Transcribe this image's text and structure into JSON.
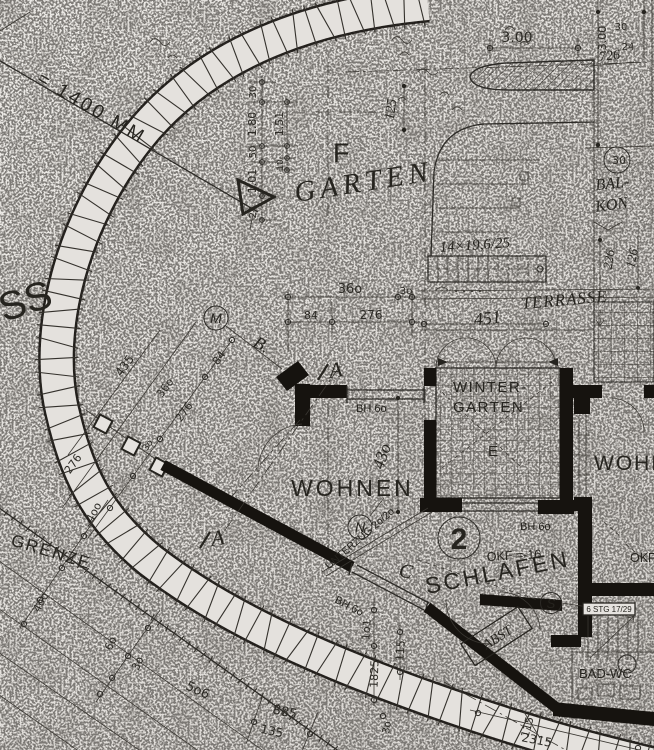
{
  "colors": {
    "paper": "#e6e3df",
    "ink": "#2a2824",
    "wall": "#16130f"
  },
  "rooms": {
    "garten": "GARTEN",
    "wohnen": "WOHNEN",
    "wohnen_right": "WOHN",
    "wintergarten_1": "WINTER-",
    "wintergarten_2": "GARTEN",
    "wintergarten_e": "E",
    "schlafen": "SCHLAFEN",
    "balkon_1": "BAL-",
    "balkon_2": "KON",
    "terrasse": "TERRASSE",
    "bad_wc": "BAD-WC",
    "abst": "ABST"
  },
  "ann": {
    "scale_note": "= 1400 MM",
    "edge_partial": "SS",
    "grenze": "GRENZE",
    "unterzug": "UNTERZUG 2o/2o",
    "stair_top": "14×19,6/25",
    "stair_right": "6 STG 17/29",
    "okf_schlafen": "OKF =-16",
    "okf_right": "OKF",
    "bh60_window": "BH 6o",
    "bh60_winter": "BH 6o",
    "bh60_wall": "BH 6o",
    "axis_f": "F"
  },
  "mk": {
    "m": "M",
    "n": "N",
    "s": "S",
    "unit": "2",
    "minus30": "-30",
    "sec_a": "A",
    "sec_a2": "A",
    "sec_b": "B.",
    "sec_c": "C"
  },
  "dims": {
    "top_300": "3.00",
    "tr_300": "3.00",
    "tr_30": "30",
    "tr_24": "24",
    "tr_726": "726",
    "lc_30": "30",
    "lc_180": "1.80",
    "lc_151": "1.51",
    "lc_50": "50",
    "lc_101": "1.01",
    "lc_10": "10",
    "lc_24": "24",
    "garten_125": "125",
    "mid_360": "36o",
    "mid_30": "3o",
    "mid_84": "84",
    "mid_276": "276",
    "diag_84": "84",
    "diag_276": "276",
    "diag_30": "3o",
    "diag_360": "36o",
    "diag_276b": "276",
    "diag_435": "435",
    "bal_226": "226",
    "bal_126": "126",
    "ter_451": "451",
    "woh_430": "43o",
    "bl_400a": "4oo",
    "bl_400b": "4oo",
    "bl_60": "6o",
    "bl_30": "3o",
    "bl_506": "5o6",
    "bl_885": "885",
    "bl_135": "135",
    "bm_101": "1o1",
    "bm_115": "115",
    "bm_1825": "1825",
    "bm_30": "3o",
    "br_115": "115",
    "br_2315": "2315"
  }
}
